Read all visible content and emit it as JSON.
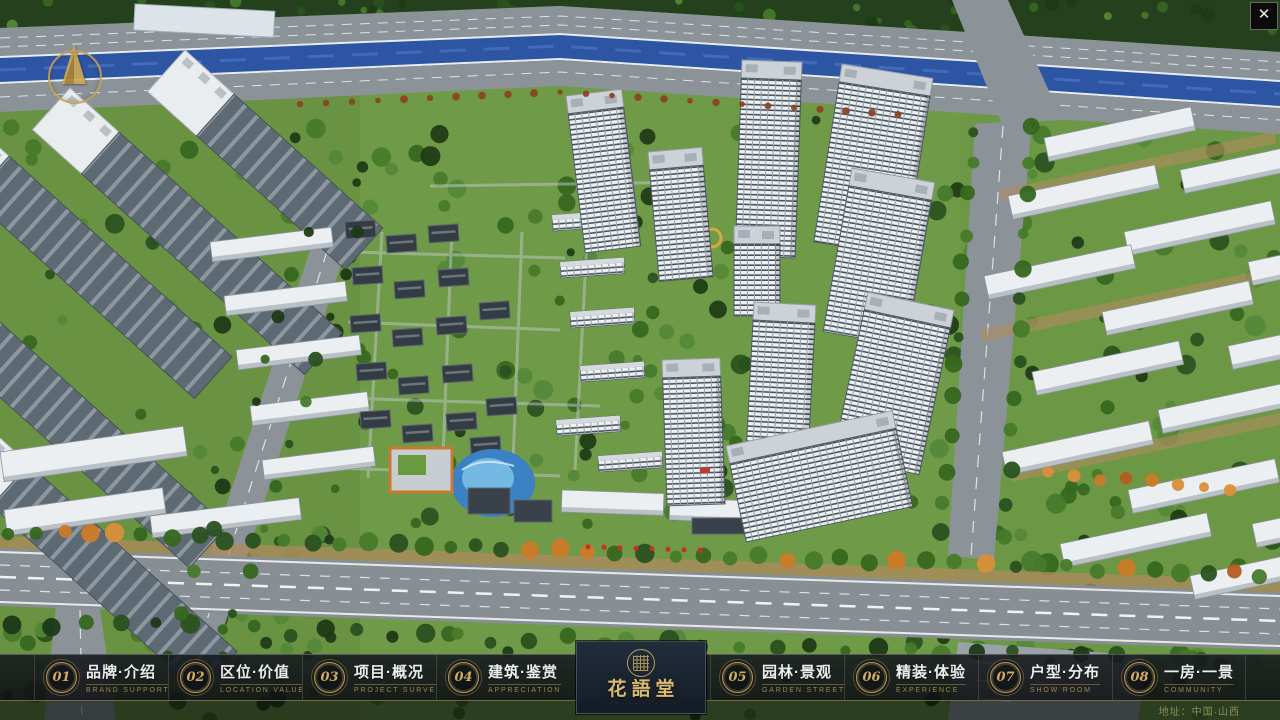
{
  "nav": {
    "items": [
      {
        "num": "01",
        "label": "品牌·介绍",
        "sub": "BRAND SUPPORT"
      },
      {
        "num": "02",
        "label": "区位·价值",
        "sub": "LOCATION VALUE"
      },
      {
        "num": "03",
        "label": "项目·概况",
        "sub": "PROJECT SURVEY"
      },
      {
        "num": "04",
        "label": "建筑·鉴赏",
        "sub": "APPRECIATION"
      },
      {
        "num": "05",
        "label": "园林·景观",
        "sub": "GARDEN STREET"
      },
      {
        "num": "06",
        "label": "精装·体验",
        "sub": "EXPERIENCE"
      },
      {
        "num": "07",
        "label": "户型·分布",
        "sub": "SHOW ROOM"
      },
      {
        "num": "08",
        "label": "一房·一景",
        "sub": "COMMUNITY"
      }
    ]
  },
  "logo": {
    "name": "花語堂",
    "tagline": "· · · · · · · · · · · ·"
  },
  "footer": {
    "address": "地址：中国·山西"
  },
  "icons": {
    "close": "✕",
    "compass": "north-arrow",
    "seal": "round-seal"
  },
  "colors": {
    "accent_gold": "#C9A25C",
    "nav_text": "#ECEDED",
    "nav_sub": "#A0854E",
    "logo_text": "#D9BA6E",
    "river_blue": "#2E55A4",
    "address_text": "#8E8C58"
  }
}
